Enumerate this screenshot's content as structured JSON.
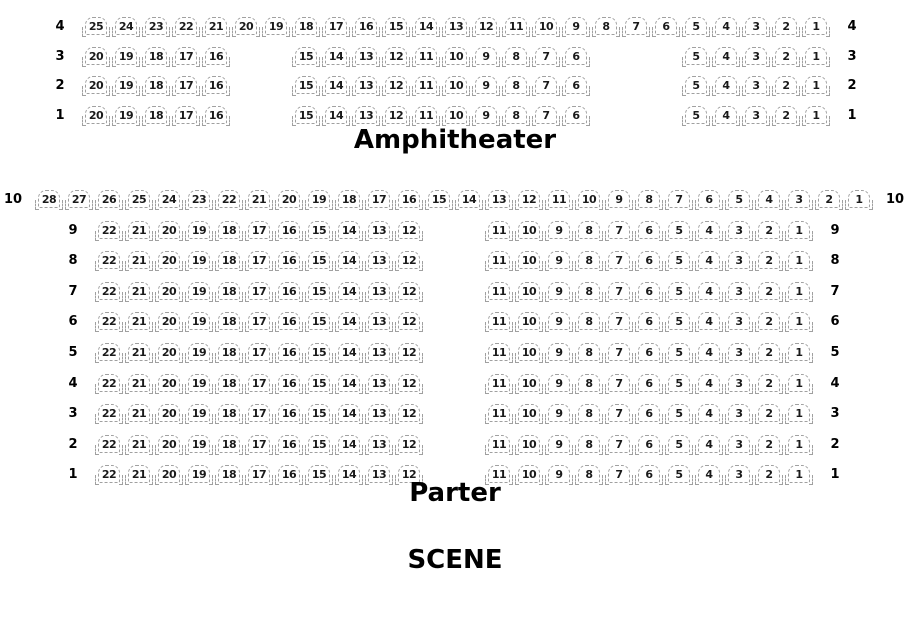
{
  "scene_label": "SCENE",
  "colors": {
    "background": "#ffffff",
    "seat_outline": "#a0a0a0",
    "seat_number": "#1a1a1a",
    "label_color": "#000000"
  },
  "sections": [
    {
      "id": "amphitheater",
      "label": "Amphitheater",
      "rows": [
        {
          "label": "4",
          "groups": [
            {
              "col": 0,
              "seats": [
                25,
                24,
                23,
                22,
                21,
                20,
                19,
                18,
                17,
                16,
                15,
                14,
                13,
                12,
                11,
                10,
                9,
                8,
                7,
                6,
                5,
                4,
                3,
                2,
                1
              ]
            }
          ]
        },
        {
          "label": "3",
          "groups": [
            {
              "col": 0,
              "seats": [
                20,
                19,
                18,
                17,
                16
              ]
            },
            {
              "col": 7,
              "seats": [
                15,
                14,
                13,
                12,
                11,
                10,
                9,
                8,
                7,
                6
              ]
            },
            {
              "col": 20,
              "seats": [
                5,
                4,
                3,
                2,
                1
              ]
            }
          ]
        },
        {
          "label": "2",
          "groups": [
            {
              "col": 0,
              "seats": [
                20,
                19,
                18,
                17,
                16
              ]
            },
            {
              "col": 7,
              "seats": [
                15,
                14,
                13,
                12,
                11,
                10,
                9,
                8,
                7,
                6
              ]
            },
            {
              "col": 20,
              "seats": [
                5,
                4,
                3,
                2,
                1
              ]
            }
          ]
        },
        {
          "label": "1",
          "groups": [
            {
              "col": 0,
              "seats": [
                20,
                19,
                18,
                17,
                16
              ]
            },
            {
              "col": 7,
              "seats": [
                15,
                14,
                13,
                12,
                11,
                10,
                9,
                8,
                7,
                6
              ]
            },
            {
              "col": 20,
              "seats": [
                5,
                4,
                3,
                2,
                1
              ]
            }
          ]
        }
      ]
    },
    {
      "id": "parter",
      "label": "Parter",
      "rows": [
        {
          "label": "10",
          "groups": [
            {
              "col": -2,
              "seats": [
                28,
                27,
                26,
                25,
                24,
                23,
                22,
                21,
                20,
                19,
                18,
                17,
                16,
                15,
                14,
                13,
                12,
                11,
                10,
                9,
                8,
                7,
                6,
                5,
                4,
                3,
                2,
                1
              ]
            }
          ]
        },
        {
          "label": "9",
          "groups": [
            {
              "col": 0,
              "seats": [
                22,
                21,
                20,
                19,
                18,
                17,
                16,
                15,
                14,
                13,
                12
              ]
            },
            {
              "col": 13,
              "seats": [
                11,
                10,
                9,
                8,
                7,
                6,
                5,
                4,
                3,
                2,
                1
              ]
            }
          ]
        },
        {
          "label": "8",
          "groups": [
            {
              "col": 0,
              "seats": [
                22,
                21,
                20,
                19,
                18,
                17,
                16,
                15,
                14,
                13,
                12
              ]
            },
            {
              "col": 13,
              "seats": [
                11,
                10,
                9,
                8,
                7,
                6,
                5,
                4,
                3,
                2,
                1
              ]
            }
          ]
        },
        {
          "label": "7",
          "groups": [
            {
              "col": 0,
              "seats": [
                22,
                21,
                20,
                19,
                18,
                17,
                16,
                15,
                14,
                13,
                12
              ]
            },
            {
              "col": 13,
              "seats": [
                11,
                10,
                9,
                8,
                7,
                6,
                5,
                4,
                3,
                2,
                1
              ]
            }
          ]
        },
        {
          "label": "6",
          "groups": [
            {
              "col": 0,
              "seats": [
                22,
                21,
                20,
                19,
                18,
                17,
                16,
                15,
                14,
                13,
                12
              ]
            },
            {
              "col": 13,
              "seats": [
                11,
                10,
                9,
                8,
                7,
                6,
                5,
                4,
                3,
                2,
                1
              ]
            }
          ]
        },
        {
          "label": "5",
          "groups": [
            {
              "col": 0,
              "seats": [
                22,
                21,
                20,
                19,
                18,
                17,
                16,
                15,
                14,
                13,
                12
              ]
            },
            {
              "col": 13,
              "seats": [
                11,
                10,
                9,
                8,
                7,
                6,
                5,
                4,
                3,
                2,
                1
              ]
            }
          ]
        },
        {
          "label": "4",
          "groups": [
            {
              "col": 0,
              "seats": [
                22,
                21,
                20,
                19,
                18,
                17,
                16,
                15,
                14,
                13,
                12
              ]
            },
            {
              "col": 13,
              "seats": [
                11,
                10,
                9,
                8,
                7,
                6,
                5,
                4,
                3,
                2,
                1
              ]
            }
          ]
        },
        {
          "label": "3",
          "groups": [
            {
              "col": 0,
              "seats": [
                22,
                21,
                20,
                19,
                18,
                17,
                16,
                15,
                14,
                13,
                12
              ]
            },
            {
              "col": 13,
              "seats": [
                11,
                10,
                9,
                8,
                7,
                6,
                5,
                4,
                3,
                2,
                1
              ]
            }
          ]
        },
        {
          "label": "2",
          "groups": [
            {
              "col": 0,
              "seats": [
                22,
                21,
                20,
                19,
                18,
                17,
                16,
                15,
                14,
                13,
                12
              ]
            },
            {
              "col": 13,
              "seats": [
                11,
                10,
                9,
                8,
                7,
                6,
                5,
                4,
                3,
                2,
                1
              ]
            }
          ]
        },
        {
          "label": "1",
          "groups": [
            {
              "col": 0,
              "seats": [
                22,
                21,
                20,
                19,
                18,
                17,
                16,
                15,
                14,
                13,
                12
              ]
            },
            {
              "col": 13,
              "seats": [
                11,
                10,
                9,
                8,
                7,
                6,
                5,
                4,
                3,
                2,
                1
              ]
            }
          ]
        }
      ]
    }
  ]
}
